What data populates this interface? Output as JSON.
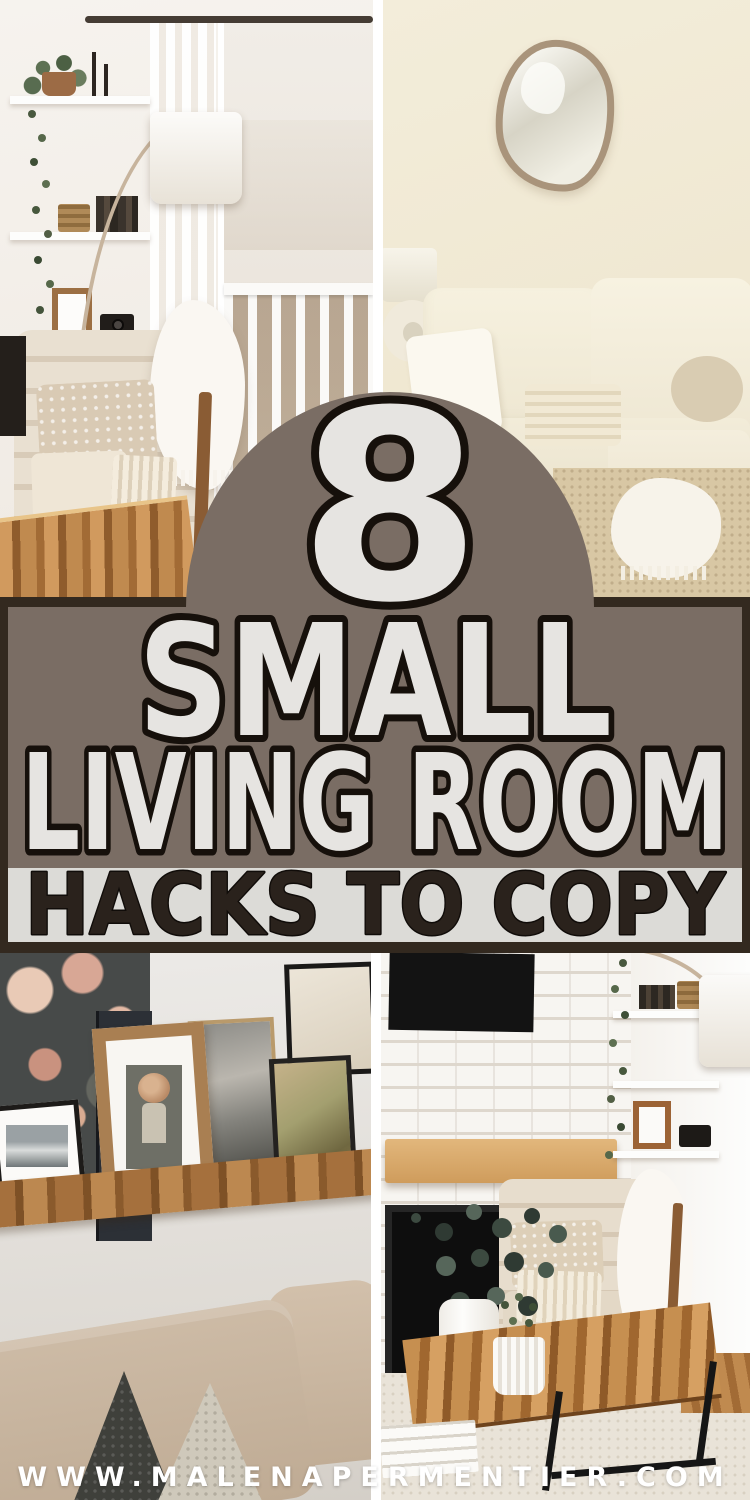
{
  "pin": {
    "badge_number": "8",
    "title_line1": "SMALL",
    "title_line2": "LIVING ROOM",
    "title_line3": "HACKS TO COPY",
    "website": "WWW.MALENAPERMENTIER.COM"
  },
  "colors": {
    "taupe": "#7a6d64",
    "dark": "#33291f",
    "band_light": "#dcdbd7",
    "text_light": "#e6e4e1",
    "text_dark": "#2a221c",
    "outline": "#16100b"
  }
}
